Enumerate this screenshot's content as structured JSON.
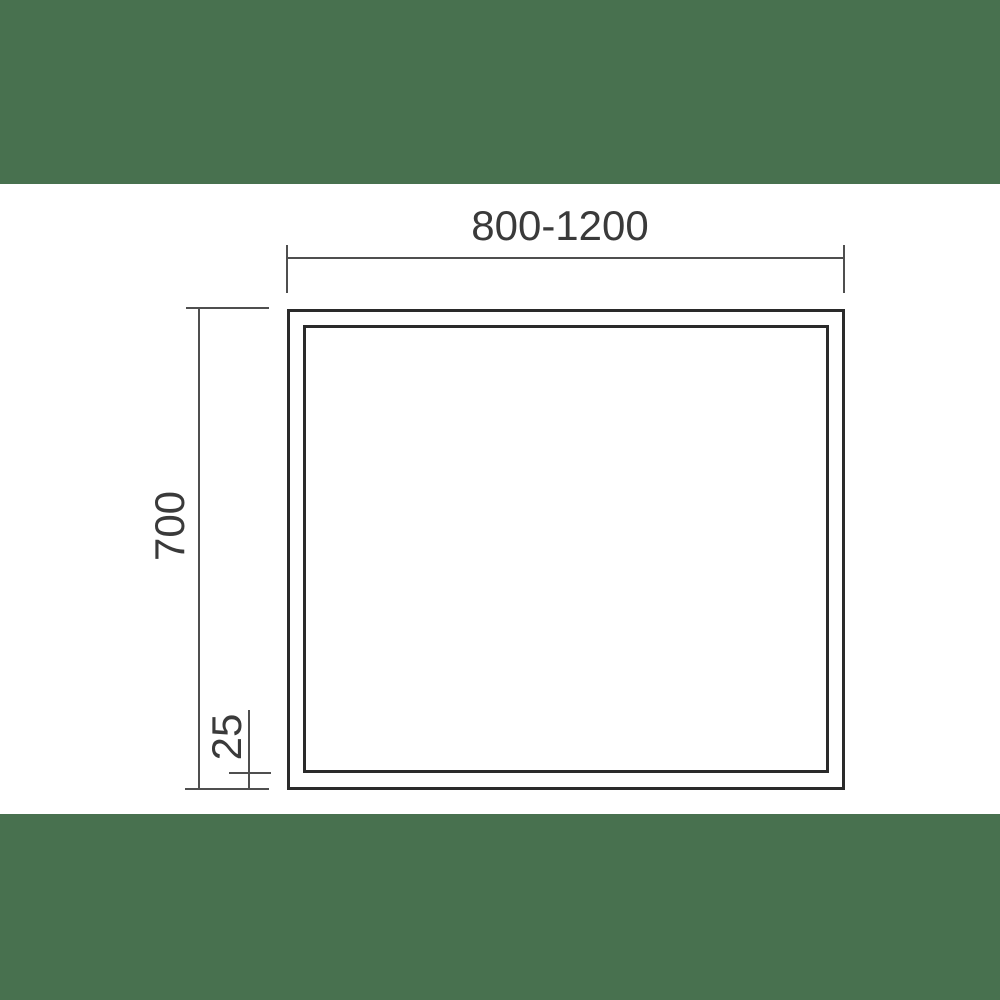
{
  "diagram": {
    "type": "technical-dimension-drawing",
    "subject": "rectangular panel, front view, double frame outline",
    "dimensions": {
      "width_label": "800-1200",
      "height_label": "700",
      "frame_thickness_label": "25"
    }
  },
  "colors": {
    "background": "#ffffff",
    "band_green": "#48714F",
    "outline": "#2a2a2a",
    "dimension_line": "#4f4f4f",
    "text": "#3a3a3a"
  }
}
